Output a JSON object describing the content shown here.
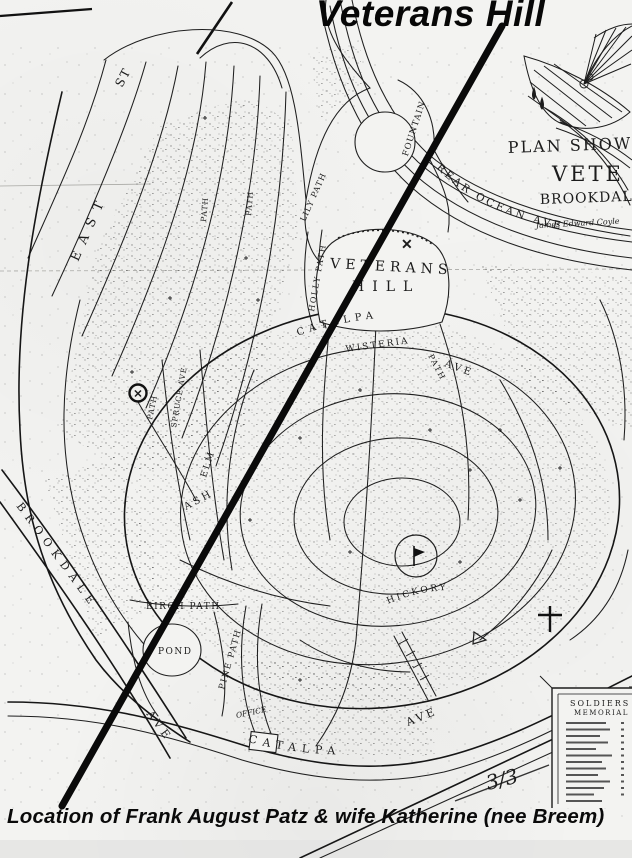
{
  "title": "Veterans Hill",
  "caption": "Location of Frank August Patz & wife Katherine (nee Breem)",
  "page_mark": "3/3",
  "plan_header": {
    "line1": "PLAN SHOWIN",
    "line2": "VETE",
    "line3": "BROOKDALE",
    "surveyor": "James Edward Coyle"
  },
  "legend": {
    "heading_line1": "SOLDIERS",
    "heading_line2": "MEMORIAL"
  },
  "hill": {
    "line1": "VETERANS",
    "line2": "HILL"
  },
  "markers": {
    "x": "✕"
  },
  "labels": {
    "east": "EAST",
    "east_st": "ST",
    "brookdale": "BROOKDALE",
    "brookdale_ave": "AVE",
    "rear_ocean_ave": "REAR OCEAN AVE",
    "holly_path": "HOLLY PATH",
    "lily_path": "LILY PATH",
    "fountain": "FOUNTAIN",
    "catalpa_upper": "CATALPA",
    "catalpa_upper_ave": "AVE",
    "wisteria": "WISTERIA",
    "hickory": "HICKORY",
    "ash": "ASH",
    "elm": "ELM",
    "spruce_ave": "SPRUCE AVE",
    "path": "PATH",
    "birch_path": "BIRCH PATH",
    "pond": "POND",
    "pine_path": "PINE PATH",
    "office": "OFFICE",
    "catalpa": "CATALPA",
    "catalpa_ave": "AVE"
  }
}
